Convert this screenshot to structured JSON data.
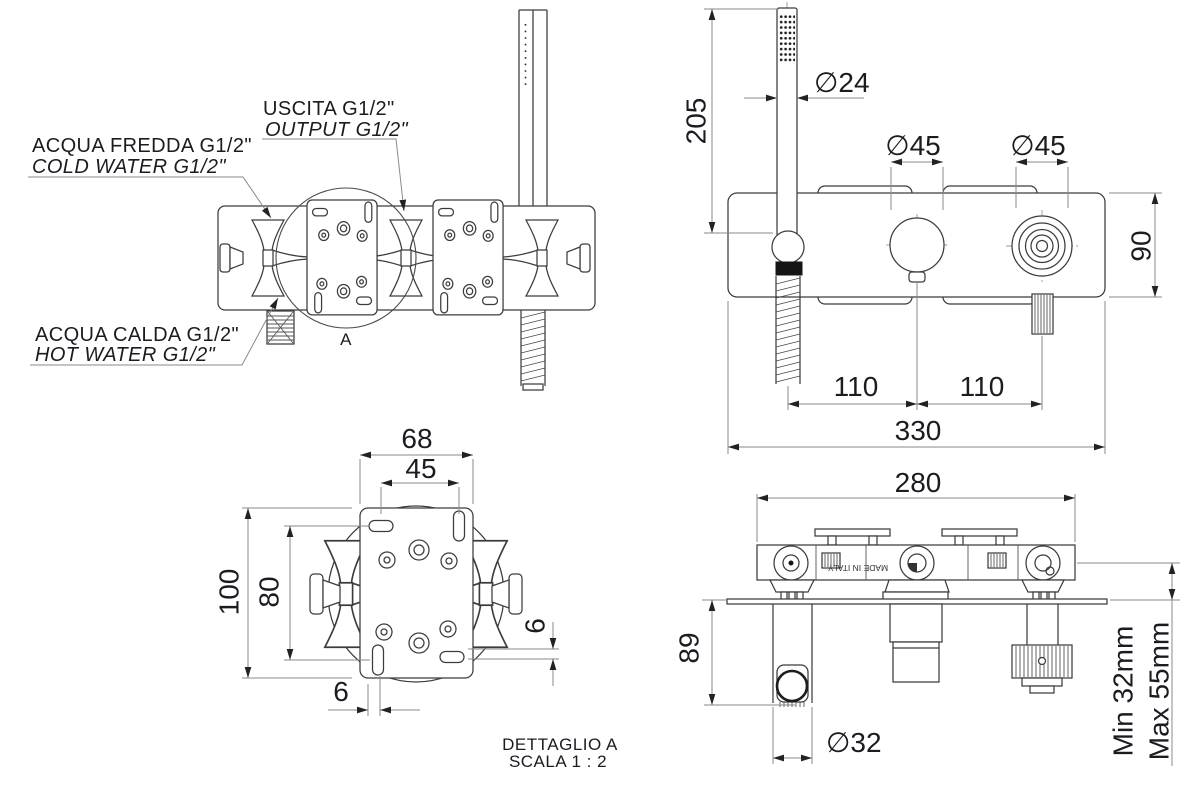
{
  "colors": {
    "line": "#3c3c3c",
    "dimension_line": "#8a8a8a",
    "text": "#1b1b22",
    "cold": "#2121dd",
    "hot": "#e02525"
  },
  "plan_view": {
    "callout_output_line1": "USCITA G1/2\"",
    "callout_output_line2": "OUTPUT G1/2\"",
    "callout_cold_line1": "ACQUA FREDDA G1/2\"",
    "callout_cold_line2": "COLD WATER G1/2\"",
    "callout_hot_line1": "ACQUA CALDA G1/2\"",
    "callout_hot_line2": "HOT WATER G1/2\"",
    "detail_marker": "A"
  },
  "front_view": {
    "dim_hand_shower_length": "205",
    "dim_hand_shower_diameter": "∅24",
    "dim_diverter_diameter": "∅45",
    "dim_handle_diameter": "∅45",
    "dim_body_height": "90",
    "dim_spacing_left": "110",
    "dim_spacing_right": "110",
    "dim_overall_width": "330"
  },
  "detail_view": {
    "dim_plate_width": "68",
    "dim_slot_spacing_horizontal": "45",
    "dim_overall_height": "100",
    "dim_slot_spacing_vertical": "80",
    "dim_slot_offset_right": "6",
    "dim_slot_offset_bottom": "6",
    "title": "DETTAGLIO A",
    "scale_note": "SCALA 1 : 2"
  },
  "side_view": {
    "dim_rough_in_width": "280",
    "dim_holder_projection": "89",
    "dim_holder_diameter": "∅32",
    "dim_plaster_depth_min": "Min 32mm",
    "dim_plaster_depth_max": "Max 55mm",
    "body_marking": "MADE IN ITALY"
  }
}
